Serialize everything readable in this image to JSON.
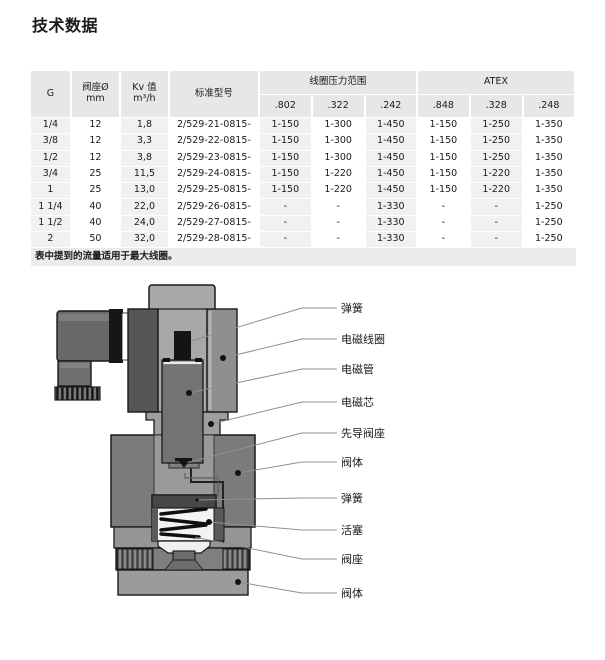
{
  "page": {
    "title": "技术数据"
  },
  "table": {
    "columns": [
      "G",
      "阀座Ø\nmm",
      "Kv 值\nm³/h",
      "标准型号"
    ],
    "groups": [
      {
        "label": "线圈压力范围"
      },
      {
        "label": "ATEX"
      }
    ],
    "subcolumns": [
      ".802",
      ".322",
      ".242",
      ".848",
      ".328",
      ".248"
    ],
    "rows": [
      [
        "1/4",
        "12",
        "1,8",
        "2/529-21-0815-",
        "1-150",
        "1-300",
        "1-450",
        "1-150",
        "1-250",
        "1-350"
      ],
      [
        "3/8",
        "12",
        "3,3",
        "2/529-22-0815-",
        "1-150",
        "1-300",
        "1-450",
        "1-150",
        "1-250",
        "1-350"
      ],
      [
        "1/2",
        "12",
        "3,8",
        "2/529-23-0815-",
        "1-150",
        "1-300",
        "1-450",
        "1-150",
        "1-250",
        "1-350"
      ],
      [
        "3/4",
        "25",
        "11,5",
        "2/529-24-0815-",
        "1-150",
        "1-220",
        "1-450",
        "1-150",
        "1-220",
        "1-350"
      ],
      [
        "1",
        "25",
        "13,0",
        "2/529-25-0815-",
        "1-150",
        "1-220",
        "1-450",
        "1-150",
        "1-220",
        "1-350"
      ],
      [
        "1 1/4",
        "40",
        "22,0",
        "2/529-26-0815-",
        "-",
        "-",
        "1-330",
        "-",
        "-",
        "1-250"
      ],
      [
        "1 1/2",
        "40",
        "24,0",
        "2/529-27-0815-",
        "-",
        "-",
        "1-330",
        "-",
        "-",
        "1-250"
      ],
      [
        "2",
        "50",
        "32,0",
        "2/529-28-0815-",
        "-",
        "-",
        "1-330",
        "-",
        "-",
        "1-250"
      ]
    ],
    "footnote": "表中提到的流量适用于最大线圈。"
  },
  "diagram": {
    "labels": [
      {
        "text": "弹簧"
      },
      {
        "text": "电磁线圈"
      },
      {
        "text": "电磁管"
      },
      {
        "text": "电磁芯"
      },
      {
        "text": "先导阀座"
      },
      {
        "text": "阀体"
      },
      {
        "text": "弹簧"
      },
      {
        "text": "活塞"
      },
      {
        "text": "阀座"
      },
      {
        "text": "阀体"
      }
    ]
  },
  "colors": {
    "header_bg": "#e7e7e7",
    "stripe_bg": "#f1f1f1",
    "footnote_bg": "#ebebeb",
    "leader_line": "#8f8f8f"
  }
}
